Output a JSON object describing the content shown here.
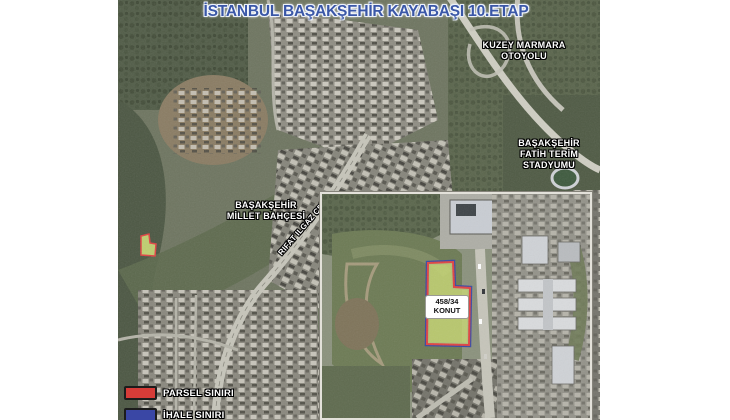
{
  "title": {
    "text": "İSTANBUL BAŞAKŞEHİR KAYABAŞI 10.ETAP",
    "color": "#3a57a7"
  },
  "map_labels": {
    "highway": [
      "KUZEY MARMARA",
      "OTOYOLU"
    ],
    "stadium": [
      "BAŞAKŞEHİR",
      "FATİH TERİM",
      "STADYUMU"
    ],
    "park": [
      "BAŞAKŞEHİR",
      "MİLLET BAHÇESİ"
    ],
    "street": "RIFAT ILGAZ CD.",
    "parcel": [
      "458/34",
      "KONUT"
    ]
  },
  "legend": {
    "items": [
      {
        "label": "PARSEL SINIRI",
        "color": "#d63c38"
      },
      {
        "label": "İHALE SINIRI",
        "color": "#3a47a5"
      }
    ]
  },
  "parcel_colors": {
    "fill": "#c5d573",
    "parsel_stroke": "#e04343",
    "ihale_stroke": "#3a47a5"
  }
}
